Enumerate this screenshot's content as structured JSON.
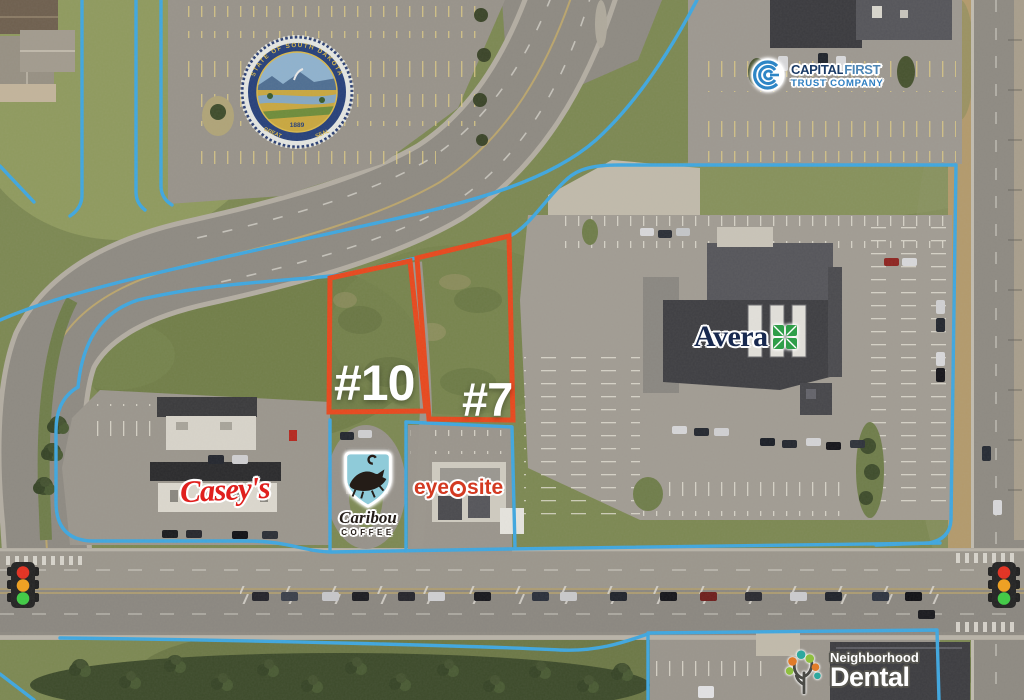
{
  "map_overlay": {
    "parcel_labels": [
      {
        "id": "lot10",
        "text": "#10"
      },
      {
        "id": "lot7",
        "text": "#7"
      }
    ]
  },
  "logos": {
    "capital_first": {
      "name_part1": "CAPITAL",
      "name_part2": "FIRST",
      "subtitle": "TRUST COMPANY"
    },
    "avera": {
      "name": "Avera"
    },
    "caseys": {
      "name": "Casey's"
    },
    "caribou": {
      "name": "Caribou",
      "subtitle": "COFFEE"
    },
    "eye_site": {
      "part1": "eye",
      "part2": "site"
    },
    "neighborhood_dental": {
      "line1": "Neighborhood",
      "line2": "Dental"
    }
  },
  "seal": {
    "ring_text": "STATE OF SOUTH DAKOTA",
    "bottom_left": "GREAT",
    "bottom_right": "SEAL",
    "year": "1889"
  },
  "icons": {
    "traffic_light": "traffic-light-icon",
    "state_seal": "south-dakota-state-seal",
    "capital_first_rings": "capital-first-logo-icon",
    "avera_cross": "avera-cross-icon",
    "caribou_shield": "caribou-shield-icon",
    "eye": "eye-icon",
    "dental_tree": "dental-tree-icon"
  },
  "colors": {
    "parcel_boundary_blue": "#3FA7E0",
    "featured_parcel_orange": "#E8481D",
    "label_white": "#FFFFFF",
    "capital_first_navy": "#1B3B66",
    "capital_first_blue": "#2E7FC2",
    "avera_navy": "#18294F",
    "avera_green": "#2F9E49",
    "caseys_red": "#E0201E",
    "caribou_teal": "#8FCBD9",
    "eye_site_red": "#D33A22",
    "traffic_red": "#E53020",
    "traffic_amber": "#F0A01E",
    "traffic_green": "#3FCB44"
  }
}
